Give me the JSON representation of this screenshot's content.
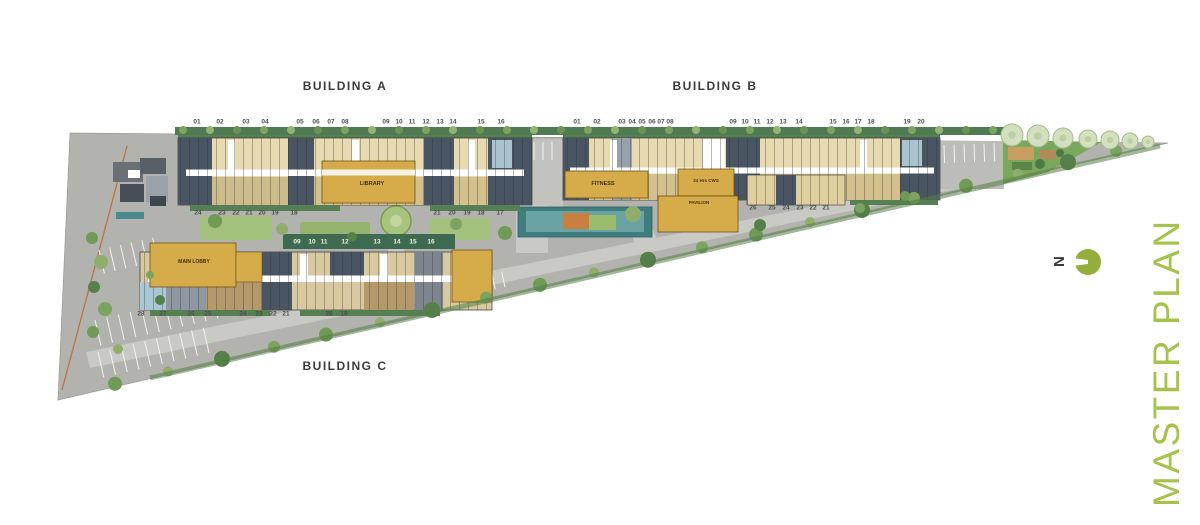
{
  "header": {
    "building_a": "BUILDING A",
    "building_b": "BUILDING B",
    "building_c": "BUILDING C"
  },
  "amenities": {
    "library": "LIBRARY",
    "fitness": "FITNESS",
    "cws": "24 Hrs CWS",
    "pavilion": "PAVILION",
    "main_lobby": "MAIN LOBBY"
  },
  "units": {
    "a_top": [
      "01",
      "02",
      "03",
      "04",
      "05",
      "06",
      "07",
      "08",
      "09",
      "10",
      "11",
      "12",
      "13",
      "14",
      "15",
      "16"
    ],
    "a_bottom_left": [
      "24",
      "23",
      "22",
      "21",
      "20",
      "19",
      "18"
    ],
    "a_bottom_right": [
      "21",
      "20",
      "19",
      "18",
      "17"
    ],
    "b_top": [
      "01",
      "02",
      "03",
      "04",
      "05",
      "06",
      "07",
      "08",
      "09",
      "10",
      "11",
      "12",
      "13",
      "14",
      "15",
      "16",
      "17",
      "18",
      "19",
      "20"
    ],
    "b_bottom": [
      "26",
      "25",
      "24",
      "23",
      "22",
      "21"
    ],
    "c_top": [
      "09",
      "10",
      "11",
      "12",
      "13",
      "14",
      "15",
      "16"
    ],
    "c_bottom": [
      "28",
      "27",
      "26",
      "25",
      "24",
      "23",
      "22",
      "21",
      "20",
      "19"
    ]
  },
  "legend": {
    "master_plan": "MASTER PLAN",
    "north": "N"
  },
  "colors": {
    "accent_green": "#a5c34a",
    "north_circle": "#94ad3b",
    "amenity_yellow": "#d6ab4a",
    "site_gray": "#b2b2ae"
  }
}
